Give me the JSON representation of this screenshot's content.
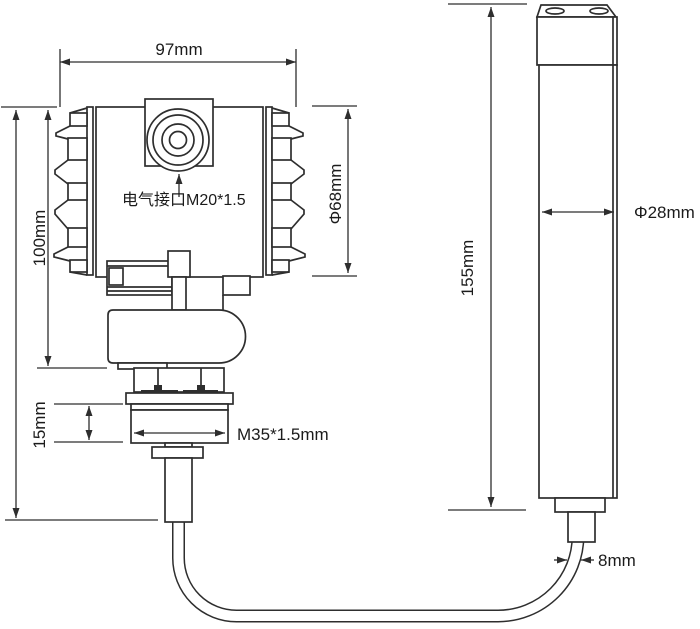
{
  "colors": {
    "line": "#2e2e2e",
    "text": "#1b1b1b",
    "bg": "#ffffff"
  },
  "labels": {
    "housing_width": "97mm",
    "housing_height": "100mm",
    "housing_diameter": "Φ68mm",
    "electrical_port": "电气接口M20*1.5",
    "process_thread": "M35*1.5mm",
    "thread_length": "15mm",
    "probe_length": "155mm",
    "probe_diameter": "Φ28mm",
    "cable_diameter": "8mm"
  }
}
